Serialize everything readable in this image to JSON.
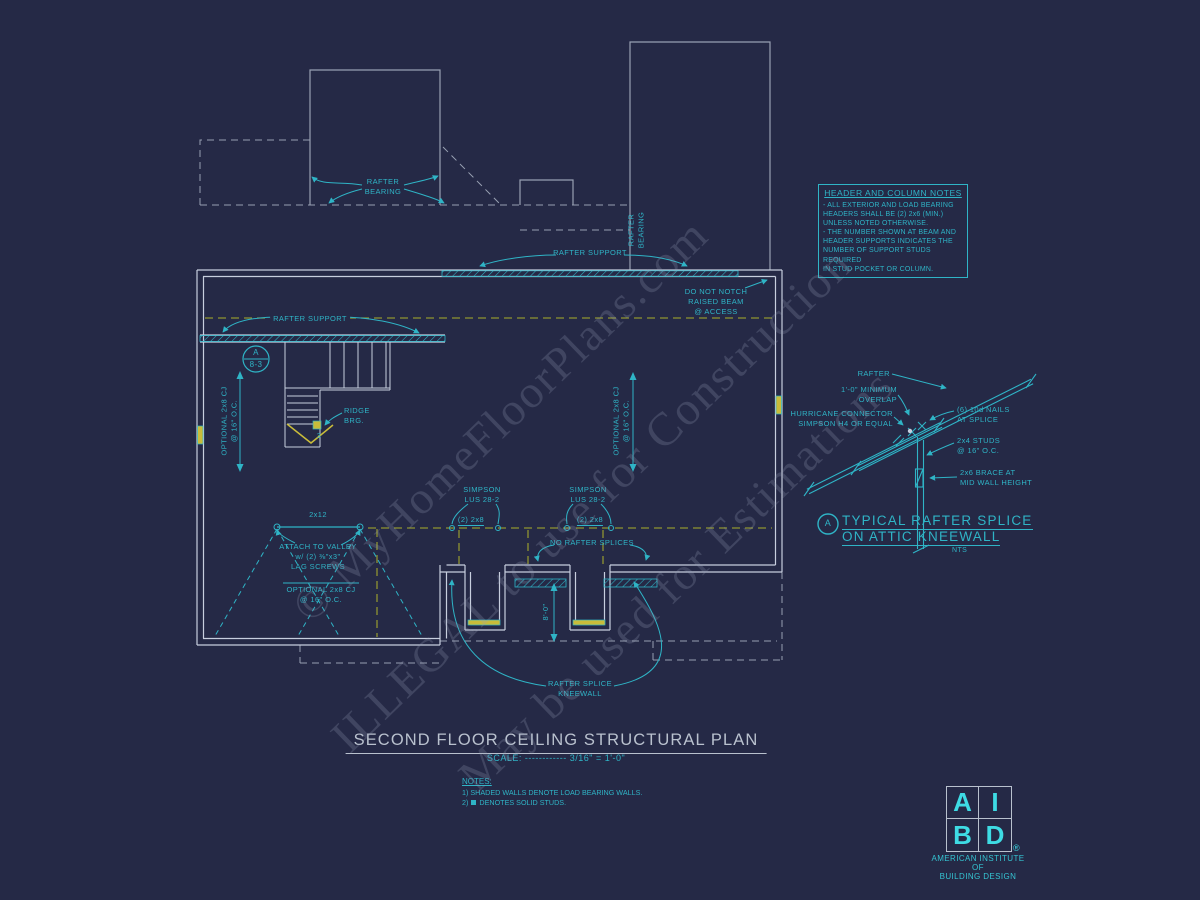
{
  "colors": {
    "teal": "#2fb4c6",
    "teal_bright": "#3edbe4",
    "wall_gray": "#c7cede",
    "roof_dash_gray": "#98a0b2",
    "bearing_olive": "#8f9431",
    "stud_yellow": "#c9bc3a",
    "background": "#252946"
  },
  "watermarks": {
    "site": "© MyHomeFloorPlans.com",
    "illegal": "ILLEGAL to use for Construction",
    "estimate": "May be used for Estimations"
  },
  "header_notes": {
    "title": "HEADER AND COLUMN NOTES",
    "lines": [
      "- ALL EXTERIOR AND LOAD BEARING",
      "HEADERS SHALL BE (2) 2x6 (MIN.)",
      "UNLESS NOTED OTHERWISE.",
      "- THE NUMBER SHOWN AT BEAM AND",
      "HEADER SUPPORTS INDICATES THE",
      "NUMBER OF SUPPORT STUDS REQUIRED",
      "IN STUD POCKET OR COLUMN."
    ]
  },
  "plan": {
    "rafter_bearing_top": [
      "RAFTER",
      "BEARING"
    ],
    "rafter_support_top": "RAFTER SUPPORT",
    "rafter_bearing_side": [
      "RAFTER",
      "BEARING"
    ],
    "do_not_notch": [
      "DO NOT NOTCH",
      "RAISED BEAM",
      "@ ACCESS"
    ],
    "rafter_support_left": "RAFTER SUPPORT",
    "callout": {
      "letter": "A",
      "sheet": "8-3"
    },
    "ridge_brg": [
      "RIDGE",
      "BRG."
    ],
    "ridge_count": "3",
    "optional_cj": [
      "OPTIONAL 2x8 CJ",
      "@ 16\" O.C."
    ],
    "collar": "2x12",
    "attach_valley": [
      "ATTACH TO VALLEY",
      "w/ (2) ⅜\"x3\"",
      "LAG SCREWS"
    ],
    "simpson": [
      "SIMPSON",
      "LUS 28-2"
    ],
    "double_2x8": "(2) 2x8",
    "no_rafter_splices": "NO RAFTER SPLICES",
    "kneewall_height": "8'-0\"",
    "rafter_splice_kneewall": [
      "RAFTER SPLICE",
      "KNEEWALL"
    ]
  },
  "detail": {
    "labels": {
      "rafter": "RAFTER",
      "overlap": [
        "1'-0\" MINIMUM",
        "OVERLAP"
      ],
      "hurricane": [
        "HURRICANE CONNECTOR",
        "SIMPSON H4 OR EQUAL"
      ],
      "nails": [
        "(6) 10d NAILS",
        "AT SPLICE"
      ],
      "studs": [
        "2x4 STUDS",
        "@ 16\" O.C."
      ],
      "brace": [
        "2x6 BRACE AT",
        "MID WALL HEIGHT"
      ]
    },
    "callout_letter": "A",
    "title": [
      "TYPICAL RAFTER SPLICE",
      "ON ATTIC KNEEWALL"
    ],
    "scale": "NTS"
  },
  "title_block": {
    "title": "SECOND FLOOR CEILING STRUCTURAL PLAN",
    "scale": "SCALE: ------------ 3/16\" = 1'-0\""
  },
  "notes": {
    "title": "NOTES:",
    "line1": "1) SHADED WALLS DENOTE LOAD BEARING WALLS.",
    "line2_prefix": "2)",
    "line2_text": "DENOTES SOLID STUDS."
  },
  "logo": {
    "a": "A",
    "i": "I",
    "b": "B",
    "d": "D",
    "reg": "®",
    "org": [
      "AMERICAN INSTITUTE",
      "OF",
      "BUILDING DESIGN"
    ]
  }
}
